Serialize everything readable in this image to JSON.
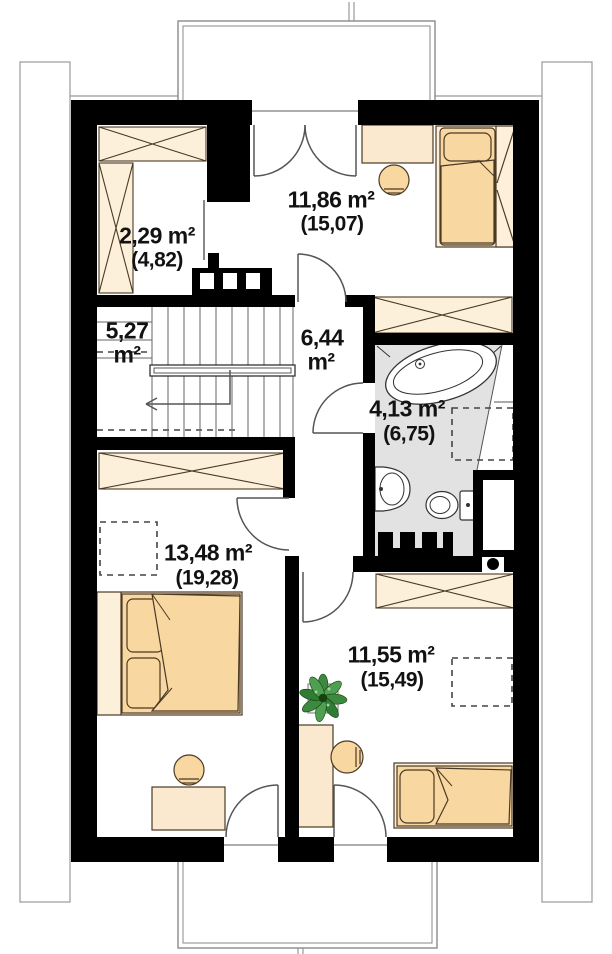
{
  "plan_title": "attic floor plan",
  "rooms": [
    {
      "id": "wardrobe-room",
      "area": "2,29 m²",
      "gross": "(4,82)"
    },
    {
      "id": "bedroom-top",
      "area": "11,86 m²",
      "gross": "(15,07)"
    },
    {
      "id": "staircase",
      "area": "5,27",
      "unit": "m²"
    },
    {
      "id": "hallway",
      "area": "6,44",
      "unit": "m²"
    },
    {
      "id": "bathroom",
      "area": "4,13 m²",
      "gross": "(6,75)"
    },
    {
      "id": "bedroom-left",
      "area": "13,48 m²",
      "gross": "(19,28)"
    },
    {
      "id": "bedroom-bottom",
      "area": "11,55 m²",
      "gross": "(15,49)"
    }
  ],
  "colors": {
    "wall": "#000000",
    "furniture_tan": "#f8d7a1",
    "furniture_cream": "#fdf0da",
    "desk_cream": "#fbe9cf",
    "bathroom_floor": "#e2e2e2",
    "plant_green": "#3c8a40",
    "outline": "#4a3a25"
  }
}
